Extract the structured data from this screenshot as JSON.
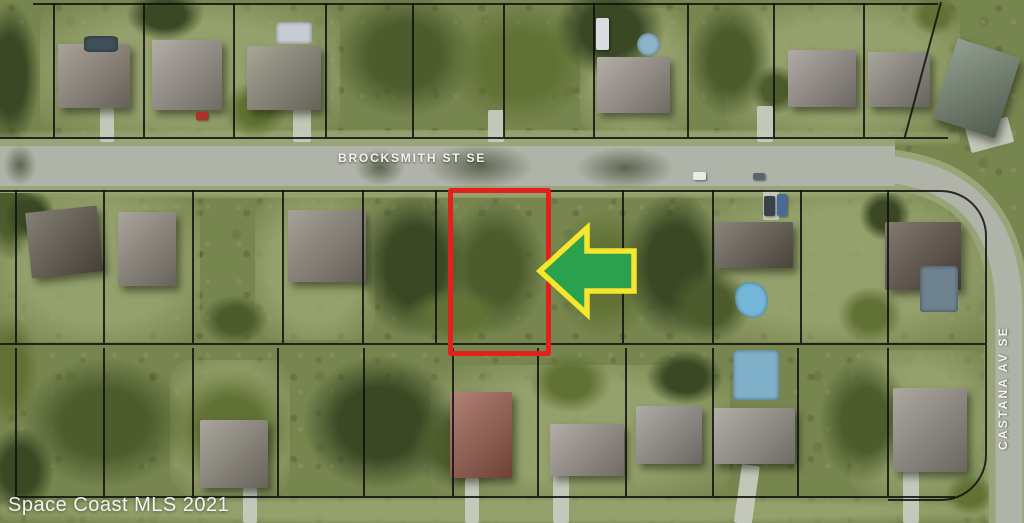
{
  "map": {
    "type": "aerial-parcel-map",
    "watermark": "Space Coast MLS 2021",
    "streets": {
      "horizontal": "BROCKSMITH ST SE",
      "vertical": "CASTANA AV SE"
    },
    "annotations": {
      "subject_lot_outline_color": "#e2211c",
      "arrow_direction": "left",
      "arrow_fill": "#2ba14e",
      "arrow_outline": "#f6e62e"
    }
  },
  "palette": {
    "grass": "#77854f",
    "lawn": "#9aa671",
    "tree_dark": "#3a4824",
    "tree_mid": "#4c5c2c",
    "tree_lite": "#617234",
    "road": "#afb3a8",
    "shoulder": "#99a478",
    "line": "#111111",
    "lot_red": "#e2211c",
    "arrow_green": "#2ba14e",
    "arrow_yellow": "#f6e62e",
    "label": "#f4f4ee"
  },
  "scene": {
    "lawns": [
      {
        "x": 40,
        "y": 5,
        "w": 300,
        "h": 130
      },
      {
        "x": 580,
        "y": 8,
        "w": 110,
        "h": 128
      },
      {
        "x": 725,
        "y": 5,
        "w": 235,
        "h": 130
      },
      {
        "x": 0,
        "y": 192,
        "w": 200,
        "h": 150
      },
      {
        "x": 255,
        "y": 195,
        "w": 120,
        "h": 145
      },
      {
        "x": 690,
        "y": 192,
        "w": 300,
        "h": 150
      },
      {
        "x": 170,
        "y": 360,
        "w": 120,
        "h": 135
      },
      {
        "x": 430,
        "y": 365,
        "w": 300,
        "h": 132
      },
      {
        "x": 850,
        "y": 350,
        "w": 140,
        "h": 147
      },
      {
        "x": 0,
        "y": 130,
        "w": 960,
        "h": 16
      },
      {
        "x": 0,
        "y": 184,
        "w": 950,
        "h": 14
      },
      {
        "x": 984,
        "y": 200,
        "w": 16,
        "h": 323
      },
      {
        "x": 0,
        "y": 498,
        "w": 1024,
        "h": 25
      }
    ],
    "trees": [
      {
        "x": -25,
        "y": -10,
        "w": 70,
        "h": 170
      },
      {
        "x": -20,
        "y": 150,
        "w": 60,
        "h": 120
      },
      {
        "x": -25,
        "y": 300,
        "w": 70,
        "h": 140
      },
      {
        "x": -20,
        "y": 420,
        "w": 80,
        "h": 100
      },
      {
        "x": 320,
        "y": -20,
        "w": 170,
        "h": 150
      },
      {
        "x": 430,
        "y": -10,
        "w": 180,
        "h": 150
      },
      {
        "x": 545,
        "y": -25,
        "w": 130,
        "h": 110
      },
      {
        "x": 680,
        "y": -10,
        "w": 100,
        "h": 140
      },
      {
        "x": 215,
        "y": 75,
        "w": 80,
        "h": 70
      },
      {
        "x": 120,
        "y": -15,
        "w": 90,
        "h": 60
      },
      {
        "x": 745,
        "y": 60,
        "w": 60,
        "h": 60
      },
      {
        "x": 905,
        "y": -10,
        "w": 60,
        "h": 50
      },
      {
        "x": 350,
        "y": 180,
        "w": 130,
        "h": 170
      },
      {
        "x": 435,
        "y": 185,
        "w": 120,
        "h": 165
      },
      {
        "x": 540,
        "y": 195,
        "w": 130,
        "h": 160
      },
      {
        "x": 615,
        "y": 180,
        "w": 120,
        "h": 170
      },
      {
        "x": 660,
        "y": 260,
        "w": 100,
        "h": 90
      },
      {
        "x": 395,
        "y": 280,
        "w": 120,
        "h": 70
      },
      {
        "x": 0,
        "y": 185,
        "w": 60,
        "h": 60
      },
      {
        "x": 195,
        "y": 290,
        "w": 80,
        "h": 60
      },
      {
        "x": 830,
        "y": 280,
        "w": 80,
        "h": 70
      },
      {
        "x": 855,
        "y": 185,
        "w": 60,
        "h": 60
      },
      {
        "x": 5,
        "y": 345,
        "w": 200,
        "h": 155
      },
      {
        "x": 150,
        "y": 355,
        "w": 160,
        "h": 145
      },
      {
        "x": 290,
        "y": 345,
        "w": 180,
        "h": 155
      },
      {
        "x": 400,
        "y": 390,
        "w": 120,
        "h": 110
      },
      {
        "x": 520,
        "y": 345,
        "w": 100,
        "h": 75
      },
      {
        "x": 640,
        "y": 345,
        "w": 90,
        "h": 65
      },
      {
        "x": 810,
        "y": 345,
        "w": 110,
        "h": 150
      },
      {
        "x": 940,
        "y": 470,
        "w": 60,
        "h": 50
      }
    ],
    "road_shadows": [
      {
        "x": 415,
        "y": 138,
        "w": 130,
        "h": 56
      },
      {
        "x": 565,
        "y": 142,
        "w": 120,
        "h": 52
      },
      {
        "x": 350,
        "y": 145,
        "w": 60,
        "h": 45
      },
      {
        "x": 0,
        "y": 140,
        "w": 40,
        "h": 50
      }
    ],
    "driveways": [
      {
        "x": 100,
        "y": 108,
        "w": 14,
        "h": 34
      },
      {
        "x": 293,
        "y": 106,
        "w": 18,
        "h": 36
      },
      {
        "x": 488,
        "y": 110,
        "w": 16,
        "h": 32
      },
      {
        "x": 757,
        "y": 106,
        "w": 16,
        "h": 36
      },
      {
        "x": 763,
        "y": 190,
        "w": 16,
        "h": 30
      },
      {
        "x": 965,
        "y": 128,
        "w": 44,
        "h": 26,
        "rot": -15
      },
      {
        "x": 243,
        "y": 488,
        "w": 14,
        "h": 35
      },
      {
        "x": 465,
        "y": 478,
        "w": 14,
        "h": 45
      },
      {
        "x": 553,
        "y": 476,
        "w": 16,
        "h": 47
      },
      {
        "x": 742,
        "y": 464,
        "w": 18,
        "h": 59,
        "rot": 8
      },
      {
        "x": 903,
        "y": 472,
        "w": 16,
        "h": 51
      }
    ],
    "houses": [
      {
        "x": 58,
        "y": 44,
        "w": 72,
        "h": 64,
        "c": "#8e867a"
      },
      {
        "x": 152,
        "y": 40,
        "w": 70,
        "h": 70,
        "c": "#9a948a"
      },
      {
        "x": 247,
        "y": 46,
        "w": 74,
        "h": 64,
        "c": "#8d8878"
      },
      {
        "x": 597,
        "y": 57,
        "w": 73,
        "h": 56,
        "c": "#9b958b"
      },
      {
        "x": 788,
        "y": 50,
        "w": 68,
        "h": 57,
        "c": "#97908a"
      },
      {
        "x": 868,
        "y": 52,
        "w": 62,
        "h": 55,
        "c": "#8e8a80"
      },
      {
        "x": 958,
        "y": 38,
        "w": 66,
        "h": 84,
        "c": "#70806d",
        "rot": 18
      },
      {
        "x": 25,
        "y": 213,
        "w": 72,
        "h": 66,
        "c": "#5f584c",
        "rot": -6
      },
      {
        "x": 118,
        "y": 212,
        "w": 58,
        "h": 74,
        "c": "#8f897d"
      },
      {
        "x": 288,
        "y": 210,
        "w": 78,
        "h": 72,
        "c": "#8a8478"
      },
      {
        "x": 715,
        "y": 222,
        "w": 78,
        "h": 46,
        "c": "#645e52"
      },
      {
        "x": 885,
        "y": 222,
        "w": 76,
        "h": 68,
        "c": "#5c5145"
      },
      {
        "x": 200,
        "y": 420,
        "w": 68,
        "h": 68,
        "c": "#8f8a7e"
      },
      {
        "x": 450,
        "y": 392,
        "w": 62,
        "h": 86,
        "c": "#9a5a4c"
      },
      {
        "x": 550,
        "y": 424,
        "w": 74,
        "h": 52,
        "c": "#9a948a"
      },
      {
        "x": 636,
        "y": 406,
        "w": 66,
        "h": 58,
        "c": "#95908a"
      },
      {
        "x": 713,
        "y": 408,
        "w": 82,
        "h": 56,
        "c": "#9a958d"
      },
      {
        "x": 893,
        "y": 388,
        "w": 74,
        "h": 84,
        "c": "#938e84"
      }
    ],
    "pools": [
      {
        "x": 84,
        "y": 36,
        "w": 34,
        "h": 16,
        "c": "#3f4f58",
        "r": "20%"
      },
      {
        "x": 276,
        "y": 22,
        "w": 36,
        "h": 22,
        "c": "#c6ccd2",
        "r": "10%"
      },
      {
        "x": 637,
        "y": 33,
        "w": 23,
        "h": 23,
        "c": "#8fb4c8",
        "r": "50%"
      },
      {
        "x": 735,
        "y": 282,
        "w": 33,
        "h": 36,
        "c": "#74b7d8",
        "r": "45% 55% 50% 60%"
      },
      {
        "x": 920,
        "y": 266,
        "w": 38,
        "h": 46,
        "c": "#6e8290",
        "r": "8%"
      },
      {
        "x": 733,
        "y": 350,
        "w": 46,
        "h": 50,
        "c": "#7fb0ca",
        "r": "8%"
      }
    ],
    "cars": [
      {
        "x": 693,
        "y": 172,
        "w": 13,
        "h": 8,
        "c": "#e8eae6"
      },
      {
        "x": 753,
        "y": 173,
        "w": 12,
        "h": 7,
        "c": "#5a6570"
      },
      {
        "x": 596,
        "y": 18,
        "w": 13,
        "h": 32,
        "c": "#d9dde0"
      },
      {
        "x": 196,
        "y": 112,
        "w": 12,
        "h": 8,
        "c": "#b03028"
      },
      {
        "x": 764,
        "y": 196,
        "w": 11,
        "h": 20,
        "c": "#3a4148"
      },
      {
        "x": 777,
        "y": 194,
        "w": 10,
        "h": 22,
        "c": "#4a6a9a"
      }
    ],
    "parcels": {
      "h": [
        {
          "x": 33,
          "y": 3,
          "w": 905
        },
        {
          "x": 0,
          "y": 137,
          "w": 948
        },
        {
          "x": 0,
          "y": 190,
          "w": 890
        },
        {
          "x": 0,
          "y": 343,
          "w": 985
        },
        {
          "x": 15,
          "y": 496,
          "w": 940
        }
      ],
      "v": [
        {
          "x": 53,
          "y": 3,
          "h": 134
        },
        {
          "x": 143,
          "y": 3,
          "h": 134
        },
        {
          "x": 233,
          "y": 3,
          "h": 134
        },
        {
          "x": 325,
          "y": 3,
          "h": 134
        },
        {
          "x": 412,
          "y": 3,
          "h": 134
        },
        {
          "x": 503,
          "y": 3,
          "h": 134
        },
        {
          "x": 593,
          "y": 3,
          "h": 134
        },
        {
          "x": 687,
          "y": 3,
          "h": 134
        },
        {
          "x": 773,
          "y": 3,
          "h": 134
        },
        {
          "x": 863,
          "y": 3,
          "h": 134
        },
        {
          "x": 15,
          "y": 190,
          "h": 153
        },
        {
          "x": 103,
          "y": 190,
          "h": 153
        },
        {
          "x": 192,
          "y": 190,
          "h": 153
        },
        {
          "x": 282,
          "y": 190,
          "h": 153
        },
        {
          "x": 362,
          "y": 190,
          "h": 153
        },
        {
          "x": 435,
          "y": 190,
          "h": 153
        },
        {
          "x": 622,
          "y": 190,
          "h": 153
        },
        {
          "x": 712,
          "y": 190,
          "h": 153
        },
        {
          "x": 800,
          "y": 190,
          "h": 153
        },
        {
          "x": 887,
          "y": 190,
          "h": 153
        },
        {
          "x": 15,
          "y": 348,
          "h": 148
        },
        {
          "x": 103,
          "y": 348,
          "h": 148
        },
        {
          "x": 192,
          "y": 348,
          "h": 148
        },
        {
          "x": 277,
          "y": 348,
          "h": 148
        },
        {
          "x": 363,
          "y": 348,
          "h": 148
        },
        {
          "x": 452,
          "y": 348,
          "h": 148
        },
        {
          "x": 537,
          "y": 348,
          "h": 148
        },
        {
          "x": 625,
          "y": 348,
          "h": 148
        },
        {
          "x": 712,
          "y": 348,
          "h": 148
        },
        {
          "x": 797,
          "y": 348,
          "h": 148
        },
        {
          "x": 887,
          "y": 348,
          "h": 148
        }
      ],
      "diag": {
        "x": 940,
        "y": 2,
        "h": 140,
        "rot": 15
      },
      "curved_boundary": {
        "x": 888,
        "y": 190,
        "w": 97,
        "h": 307,
        "radius": 46
      }
    }
  }
}
